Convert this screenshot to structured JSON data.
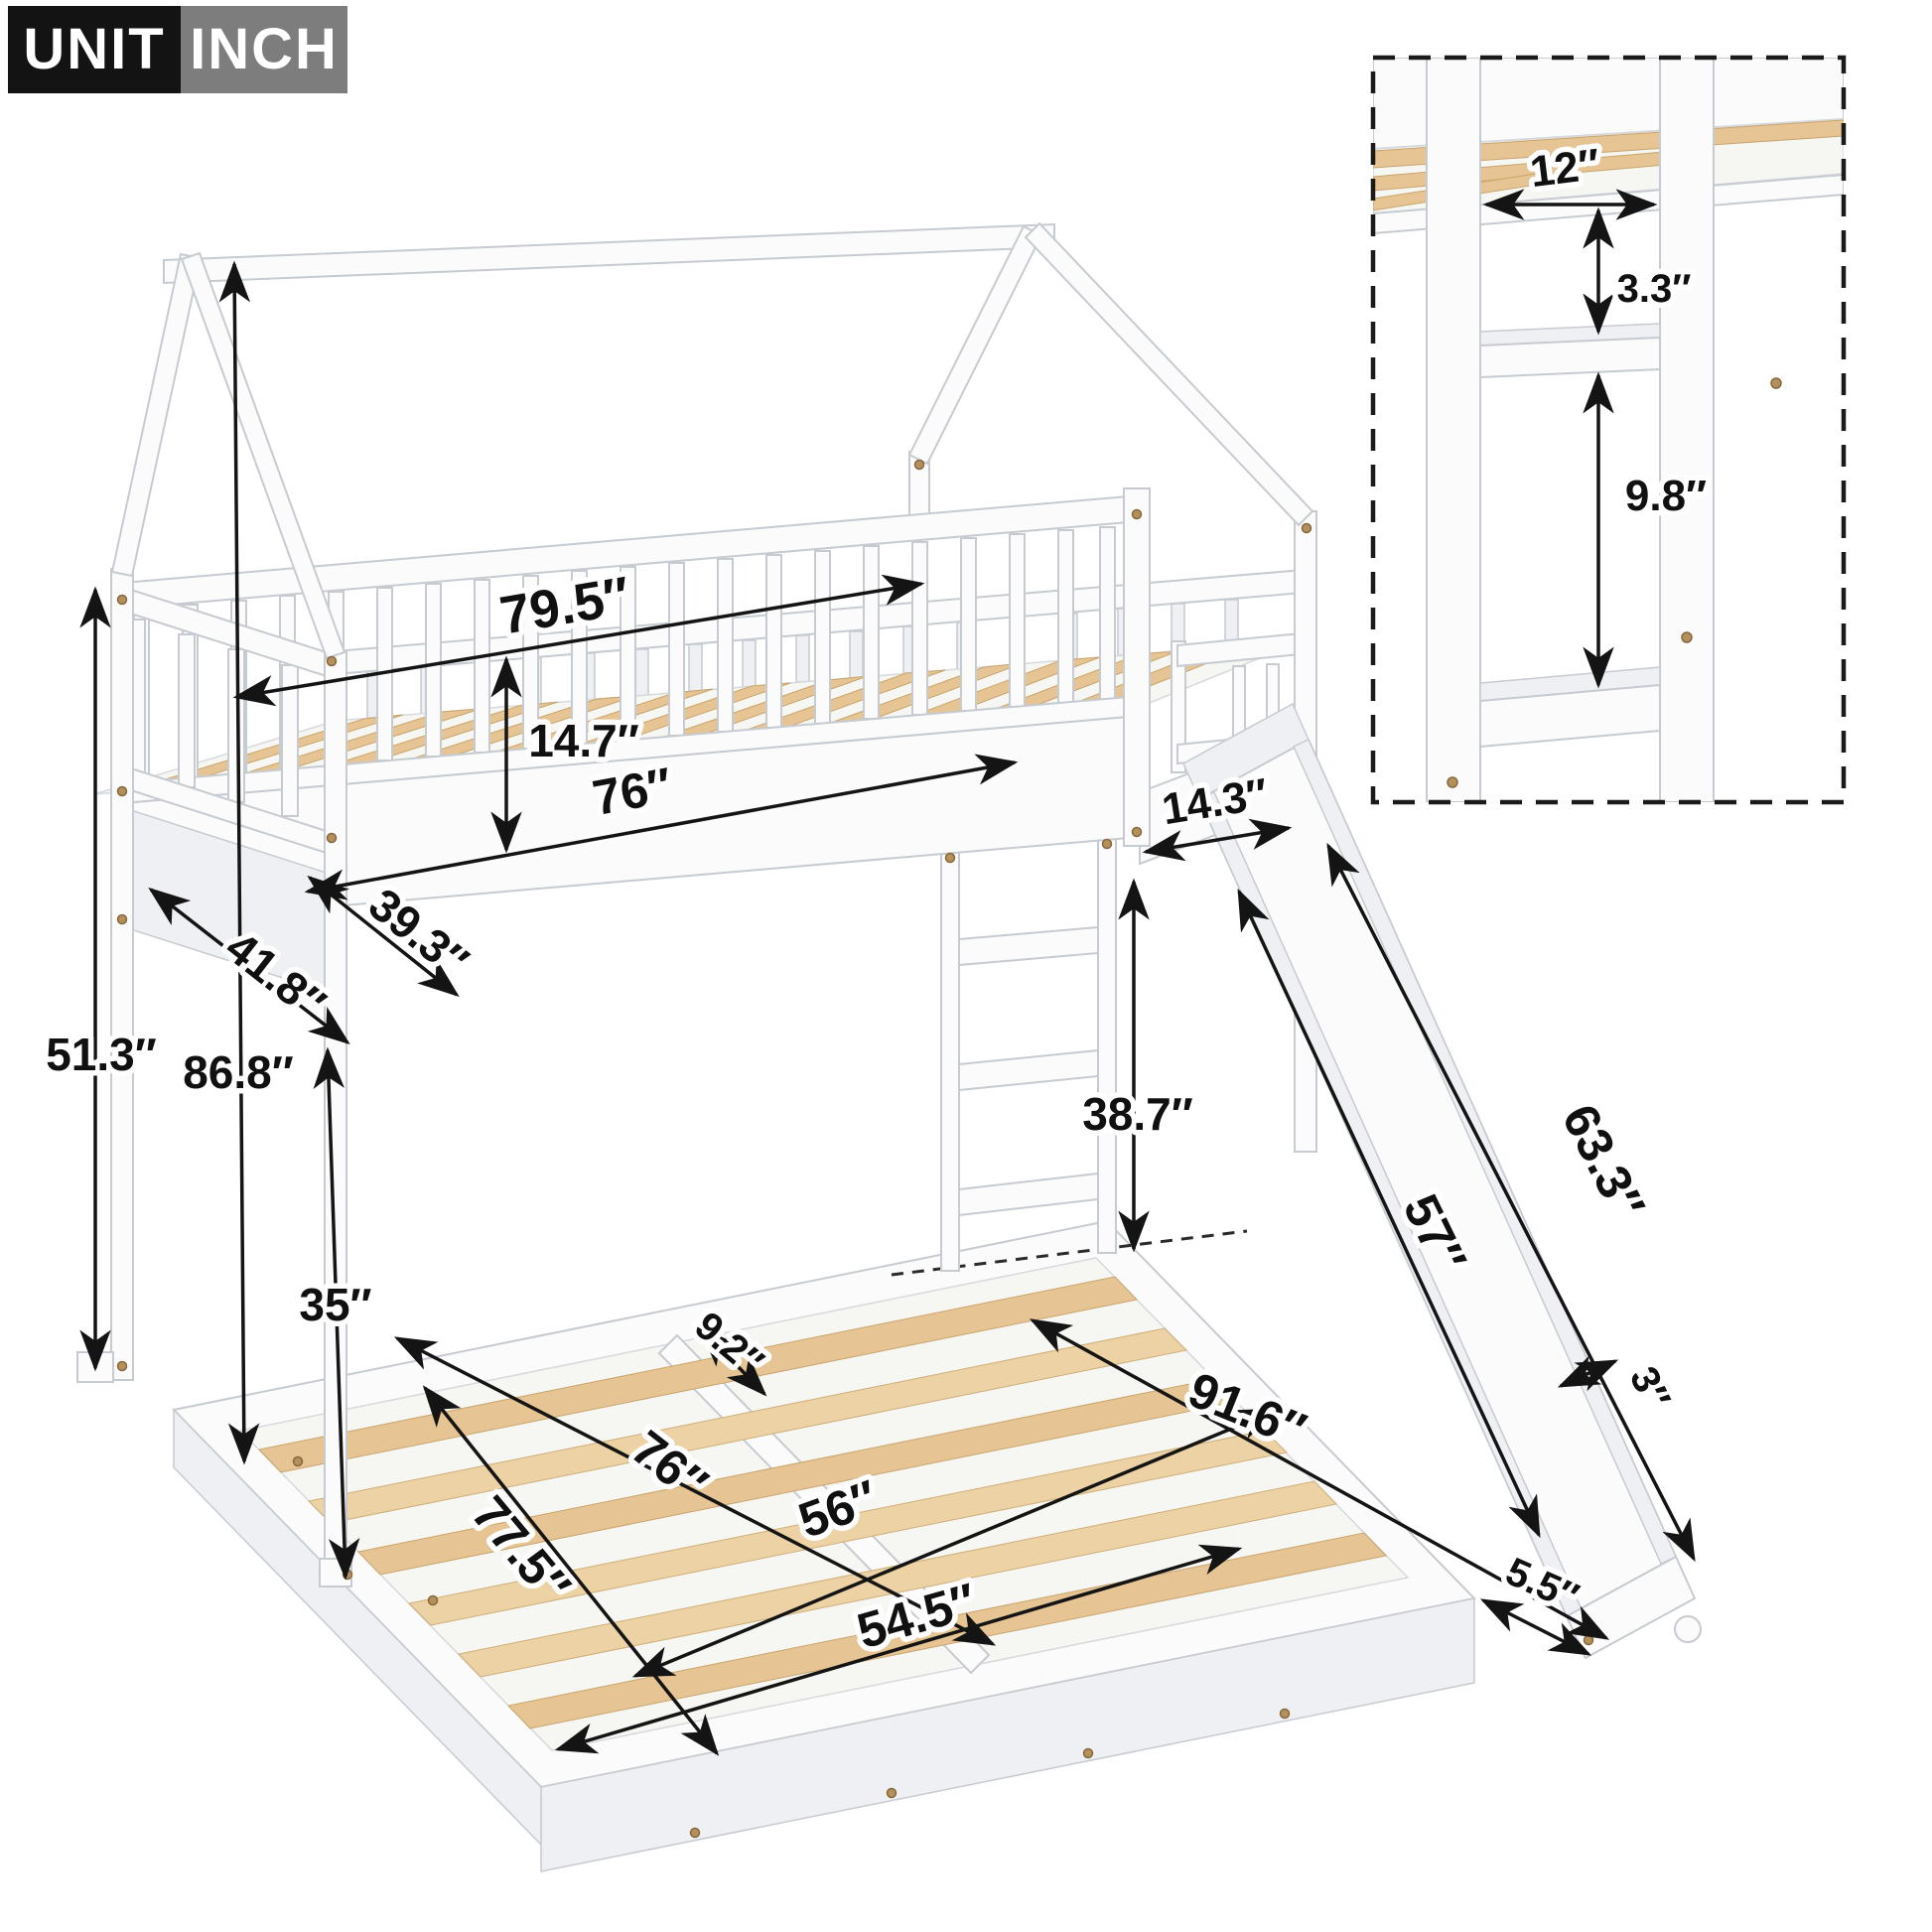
{
  "unit_badge": {
    "label": "UNIT",
    "value": "INCH"
  },
  "colors": {
    "badge_label_bg": "#131313",
    "badge_value_bg": "#7d7d7d",
    "badge_text": "#ffffff",
    "frame_white": "#fbfbfc",
    "outline_gray": "#c6cbd1",
    "wood_slat": "#e6c493",
    "dimension_black": "#141414"
  },
  "inset_detail": {
    "step_width": "12″",
    "step_gap_top": "3.3″",
    "step_gap_bottom": "9.8″"
  },
  "dimensions": {
    "upper_frame_length": "79.5″",
    "guardrail_height": "14.7″",
    "upper_bed_length": "76″",
    "upper_bed_width": "39.3″",
    "upper_frame_width": "41.8″",
    "rail_to_floor_height": "51.3″",
    "overall_height": "86.8″",
    "slide_opening": "14.3″",
    "ladder_clearance_height": "38.7″",
    "under_bunk_height": "35″",
    "slide_outer_length": "63.3″",
    "slide_inner_length": "57″",
    "slide_depth": "3″",
    "slat_gap": "9.2″",
    "lower_bed_length": "76″",
    "lower_bed_width": "56″",
    "lower_frame_length": "77.5″",
    "lower_slat_length": "54.5″",
    "total_footprint_length": "91.6″",
    "slide_foot_width": "5.5″"
  }
}
